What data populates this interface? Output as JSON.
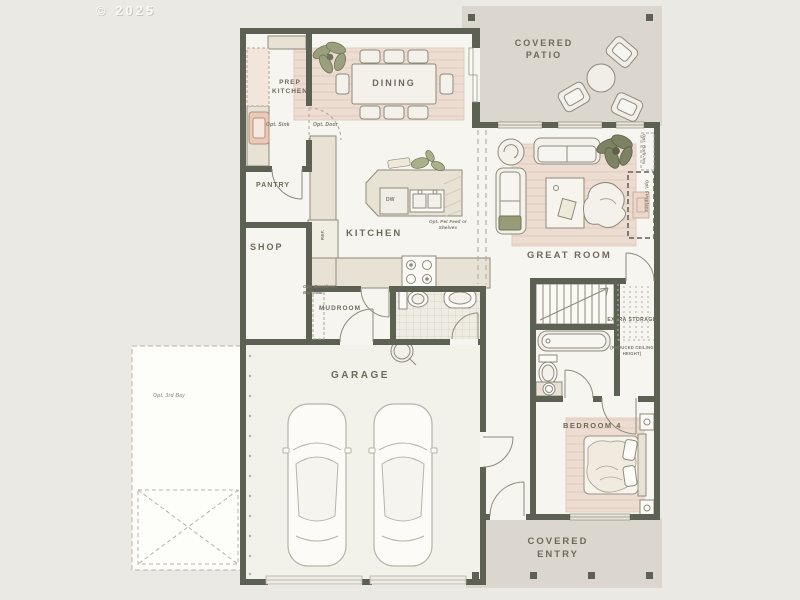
{
  "meta": {
    "copyright": "© 2025"
  },
  "colors": {
    "background": "#ebe9e4",
    "wall": "#5d6153",
    "patio_fill": "#dcd7ce",
    "interior_fill": "#f6f5f0",
    "rug_pink": "#eddcd1",
    "counter_beige": "#e8e2d4",
    "accent_pink": "#e9c9b7",
    "plant_green": "#8a9070",
    "label_text": "#6e695b"
  },
  "rooms": {
    "covered_patio": {
      "label": "COVERED PATIO"
    },
    "prep_kitchen": {
      "label": "PREP KITCHEN"
    },
    "dining": {
      "label": "DINING"
    },
    "pantry": {
      "label": "PANTRY"
    },
    "shop": {
      "label": "SHOP"
    },
    "kitchen": {
      "label": "KITCHEN"
    },
    "great_room": {
      "label": "GREAT ROOM"
    },
    "mudroom": {
      "label": "MUDROOM"
    },
    "garage": {
      "label": "GARAGE"
    },
    "bedroom_4": {
      "label": "BEDROOM 4"
    },
    "covered_entry": {
      "label": "COVERED ENTRY"
    },
    "extra_storage": {
      "label_line1": "EXTRA STORAGE",
      "label_line2": "(REDUCED CEILING HEIGHT)"
    }
  },
  "annotations": {
    "opt_sink": "Opt. Sink",
    "opt_door": "Opt. Door",
    "opt_pet_feed": "Opt. Pet Feed or Shelves",
    "opt_bench": "Opt. Bench or Built-ins",
    "opt_3rd_bay": "Opt. 3rd Bay",
    "opt_built_ins": "Opt. Built-Ins",
    "opt_fireplace": "Opt. Fireplace",
    "refrigerator": "REF.",
    "dishwasher": "DW"
  }
}
